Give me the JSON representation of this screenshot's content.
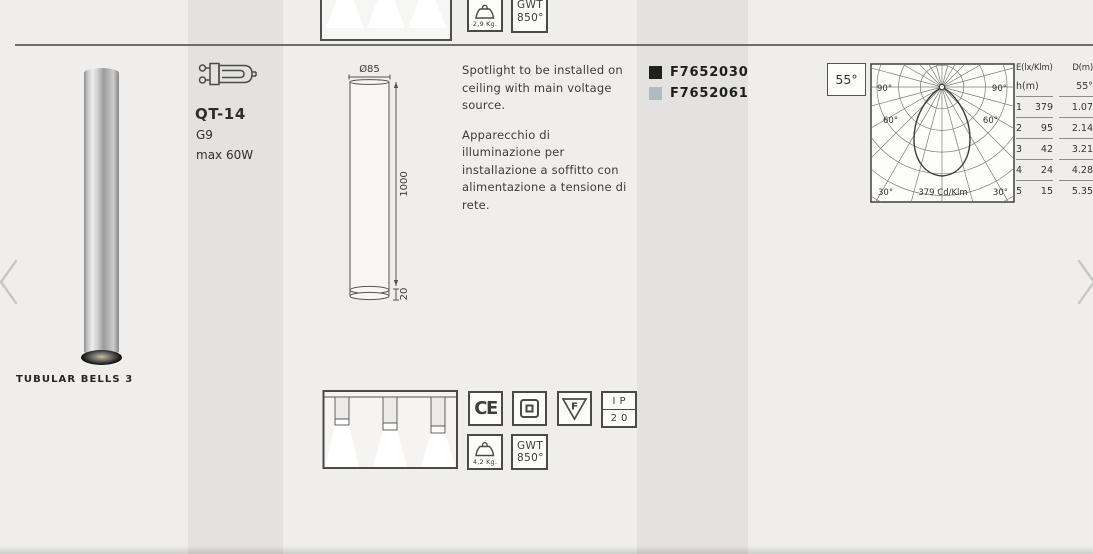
{
  "page": {
    "product_name": "TUBULAR BELLS 3",
    "lamp_type": "QT-14",
    "lamp_socket": "G9",
    "lamp_power": "max 60W",
    "description_en": "Spotlight to be installed on ceiling with main voltage source.",
    "description_it": "Apparecchio di illuminazione per installazione a soffitto con alimentazione a tensione di rete.",
    "codes": [
      {
        "code": "F7652030",
        "swatch_color": "#1f1f1d"
      },
      {
        "code": "F7652061",
        "swatch_color": "#b3bbbe"
      }
    ],
    "drawing": {
      "diameter_label": "Ø85",
      "height_label": "1000",
      "base_label": "20"
    },
    "beam_angle_label": "55°",
    "photometry": {
      "max_intensity_label": "379 Cd/Klm",
      "label_90_left": "90°",
      "label_90_right": "90°",
      "label_60_left": "60°",
      "label_60_right": "60°",
      "label_30_left": "30°",
      "label_30_right": "30°"
    },
    "illuminance_table": {
      "header_left": "E(lx/Klm)",
      "header_right": "D(m)",
      "subheader_left": "h(m)",
      "subheader_right": "55°",
      "rows": [
        {
          "h": "1",
          "e": "379",
          "d": "1.07"
        },
        {
          "h": "2",
          "e": "95",
          "d": "2.14"
        },
        {
          "h": "3",
          "e": "42",
          "d": "3.21"
        },
        {
          "h": "4",
          "e": "24",
          "d": "4.28"
        },
        {
          "h": "5",
          "e": "15",
          "d": "5.35"
        }
      ]
    },
    "previous_row": {
      "weight": "2,9 Kg.",
      "gwt_line1": "GWT",
      "gwt_line2": "850°"
    },
    "certifications": {
      "ce": "CE",
      "f_mark": "F",
      "ip_line1": "IP",
      "ip_line2": "20",
      "weight": "4,2 Kg.",
      "gwt_line1": "GWT",
      "gwt_line2": "850°"
    }
  }
}
